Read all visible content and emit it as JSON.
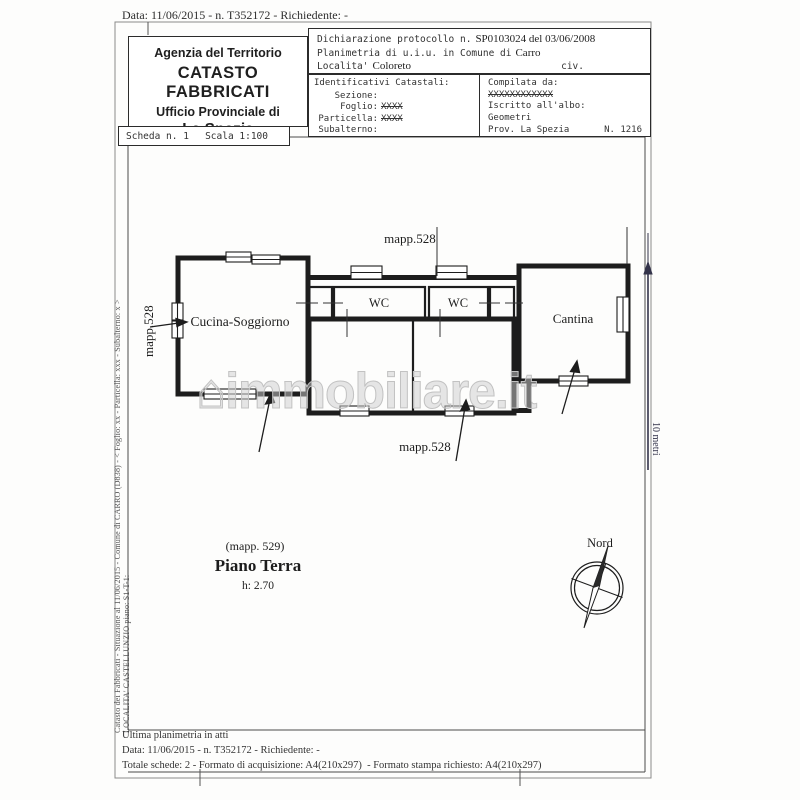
{
  "colors": {
    "paper": "#fdfdfc",
    "ink": "#2a2a2a",
    "frame": "#444444",
    "watermark": "#c2c2c2"
  },
  "header_strip": {
    "date_line": "Data: 11/06/2015 - n. T352172 - Richiedente: -"
  },
  "agency_box": {
    "line1": "Agenzia del Territorio",
    "line2": "CATASTO FABBRICATI",
    "line3": "Ufficio Provinciale di",
    "line4": "La Spezia"
  },
  "scheda_box": {
    "scheda": "Scheda n. 1",
    "scala": "Scala 1:100"
  },
  "protocol_box": {
    "l1_label": "Dichiarazione protocollo n.",
    "l1_value": "SP0103024 del 03/06/2008",
    "l2_label": "Planimetria di u.i.u. in Comune di",
    "l2_value": "Carro",
    "l3_label": "Localita'",
    "l3_value": "Coloreto",
    "l3_right": "civ."
  },
  "catastali_box": {
    "title": "Identificativi Catastali:",
    "rows": [
      {
        "label": "Sezione:",
        "value": ""
      },
      {
        "label": "Foglio:",
        "value": "XXXX"
      },
      {
        "label": "Particella:",
        "value": "XXXX"
      },
      {
        "label": "Subalterno:",
        "value": ""
      }
    ],
    "compilata_label": "Compilata da:",
    "compilata_value": "XXXXXXXXXXXX",
    "albo_label": "Iscritto all'albo:",
    "albo_value": "Geometri",
    "prov": "Prov. La Spezia",
    "num": "N. 1216"
  },
  "plan": {
    "mapp_top": "mapp.528",
    "mapp_left": "mapp.528",
    "mapp_bottom": "mapp.528",
    "room_kitchen": "Cucina-Soggiorno",
    "room_wc1": "WC",
    "room_wc2": "WC",
    "room_cantina": "Cantina",
    "mapp_ref": "(mapp. 529)",
    "floor_title": "Piano Terra",
    "floor_height": "h: 2.70",
    "compass_label": "Nord",
    "scale_label": "10 metri",
    "watermark_house": "⌂",
    "watermark_text": "immobiliare.it"
  },
  "sidebar": {
    "line1": "Catasto dei Fabbricati - Situazione al 11/06/2015 - Comune di CARRO (D838) - < Foglio: xx - Particella: xxx - Subalterno: x >",
    "line2": "LOCALITA' CASTELLUNZIO piano: S1-T-1:"
  },
  "footer": {
    "line1": "Ultima planimetria in atti",
    "line2": "Data: 11/06/2015 - n. T352172 - Richiedente: -",
    "line3": "Totale schede: 2 - Formato di acquisizione: A4(210x297)  - Formato stampa richiesto: A4(210x297)"
  }
}
